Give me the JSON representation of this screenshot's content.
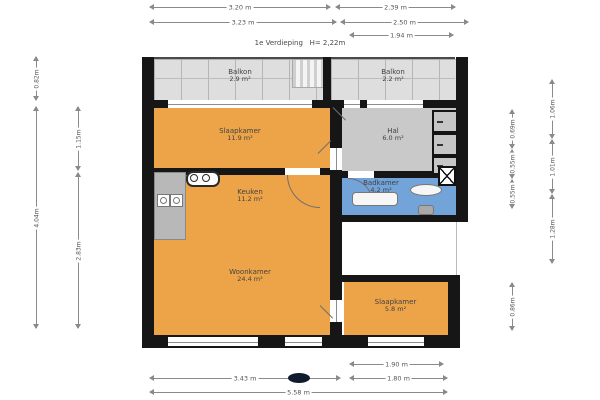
{
  "title": "1e Verdieping   H= 2,22m",
  "rooms": {
    "balkon_left": {
      "name": "Balkon",
      "area": "2.9 m²"
    },
    "balkon_right": {
      "name": "Balkon",
      "area": "2.2 m²"
    },
    "slaapkamer_1": {
      "name": "Slaapkamer",
      "area": "11.9 m²"
    },
    "hal": {
      "name": "Hal",
      "area": "6.0 m²"
    },
    "keuken": {
      "name": "Keuken",
      "area": "11.2 m²"
    },
    "badkamer": {
      "name": "Badkamer",
      "area": "4.2 m²"
    },
    "woonkamer": {
      "name": "Woonkamer",
      "area": "24.4 m²"
    },
    "slaapkamer_2": {
      "name": "Slaapkamer",
      "area": "5.8 m²"
    }
  },
  "dimensions": {
    "top_row1_left": "3.20 m",
    "top_row1_right": "2.39 m",
    "top_row2_left": "3.23 m",
    "top_row2_right": "2.50 m",
    "top_row3_right": "1.94 m",
    "bottom_row1_right": "1.90 m",
    "bottom_row2_left": "3.43 m",
    "bottom_row2_right": "1.80 m",
    "bottom_row3": "5.58 m",
    "left_outer_top": "0.82m",
    "left_outer_main": "4.04m",
    "left_inner_top": "1.15m",
    "left_inner_main": "2.83m",
    "right_inner_1": "0.69m",
    "right_inner_2": "0.55m",
    "right_inner_3": "0.55m",
    "right_inner_low": "0.86m",
    "right_outer_1": "1.06m",
    "right_outer_2": "1.01m",
    "right_outer_3": "1.28m"
  },
  "colors": {
    "floor_orange": "#eda448",
    "floor_gray": "#c9c9c9",
    "floor_blue": "#72a3d9",
    "balcony_gray": "#dedede",
    "wall_black": "#161616"
  },
  "icons": {
    "north_marker": "compass-ellipse",
    "shaft": "x-box",
    "cooktop": "two-burner-stove",
    "sink": "double-basin"
  }
}
